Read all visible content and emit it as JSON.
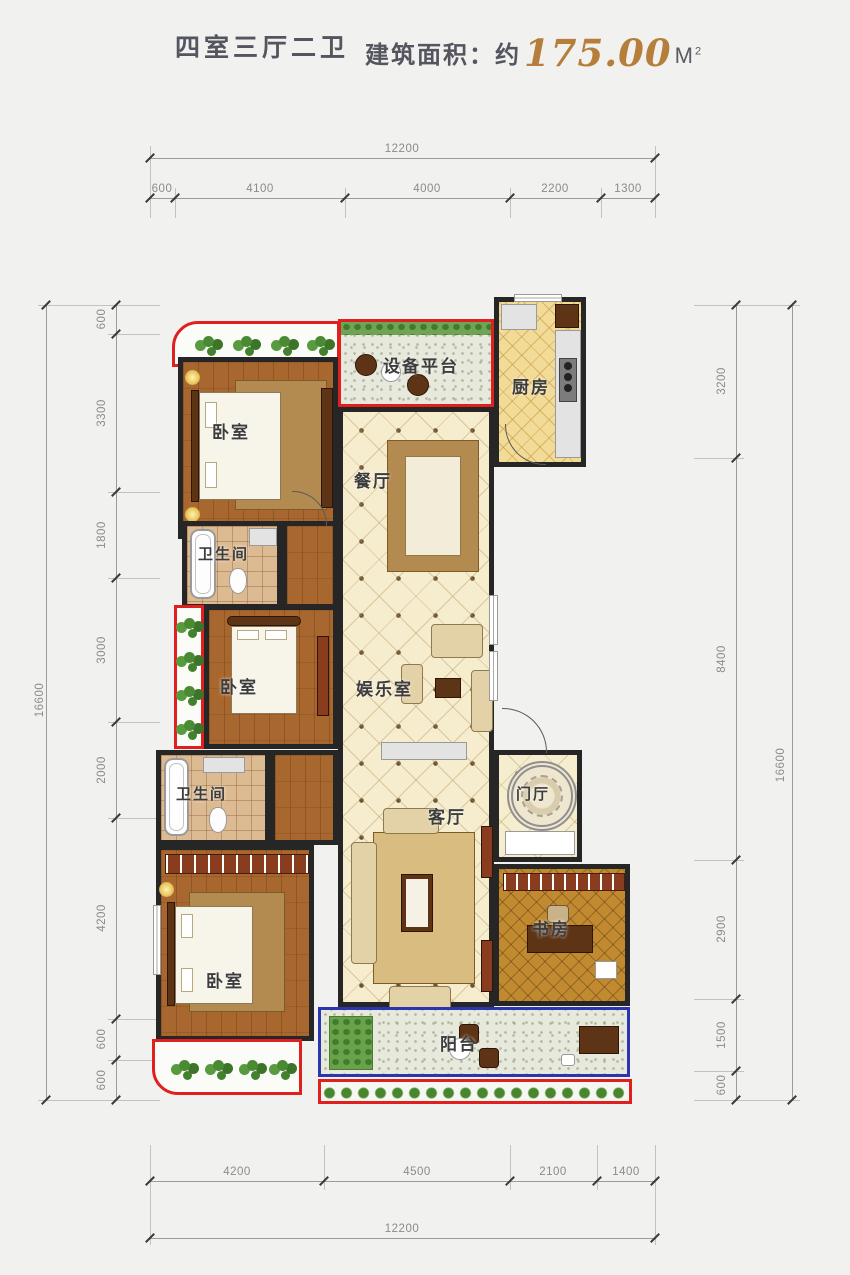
{
  "header": {
    "title": "四室三厅二卫",
    "area_label": "建筑面积：约",
    "area_value": "175.00",
    "area_unit": "M",
    "area_unit_sup": "2"
  },
  "dimensions": {
    "top": {
      "total": "12200",
      "segments": [
        "600",
        "4100",
        "4000",
        "2200",
        "1300"
      ]
    },
    "bottom": {
      "total": "12200",
      "segments": [
        "4200",
        "4500",
        "2100",
        "1400"
      ]
    },
    "left": {
      "total": "16600",
      "segments": [
        "600",
        "3300",
        "1800",
        "3000",
        "2000",
        "4200",
        "600",
        "600"
      ]
    },
    "right": {
      "total": "16600",
      "segments": [
        "3200",
        "8400",
        "2900",
        "1500",
        "600"
      ]
    }
  },
  "rooms": {
    "equipment_platform": "设备平台",
    "kitchen": "厨房",
    "bedroom_top": "卧室",
    "dining": "餐厅",
    "bathroom_top": "卫生间",
    "bedroom_mid": "卧室",
    "entertainment": "娱乐室",
    "bathroom_bottom": "卫生间",
    "living": "客厅",
    "bedroom_bottom": "卧室",
    "study": "书房",
    "entry": "门厅",
    "balcony": "阳台"
  },
  "colors": {
    "wall": "#262626",
    "red_outline": "#e01f1f",
    "blue_outline": "#2c35b0",
    "gold_number": "#b57e3a",
    "dimension_text": "#8b8b8b"
  }
}
